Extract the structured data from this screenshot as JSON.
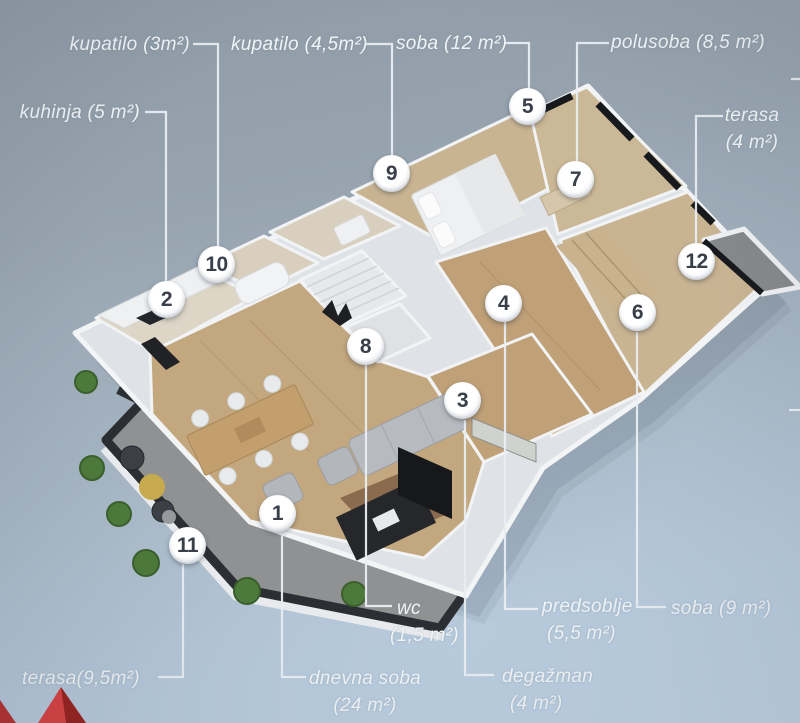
{
  "page": {
    "type": "3d-floor-plan-render"
  },
  "colors": {
    "background_top": "#8e9aa5",
    "background_bottom": "#c0d3e5",
    "label_text": "#f0f4f7",
    "marker_text": "#39404a",
    "connector_line": "#e9eef3",
    "logo_red": "#d84040",
    "logo_red_dark": "#97201c",
    "terrace_wall": "#2b2f34",
    "wood_floor": "#c3a77e",
    "window_glass": "#17191c"
  },
  "markers": [
    {
      "number": "1"
    },
    {
      "number": "2"
    },
    {
      "number": "3"
    },
    {
      "number": "4"
    },
    {
      "number": "5"
    },
    {
      "number": "6"
    },
    {
      "number": "7"
    },
    {
      "number": "8"
    },
    {
      "number": "9"
    },
    {
      "number": "10"
    },
    {
      "number": "11"
    },
    {
      "number": "12"
    }
  ],
  "labels": {
    "kupatilo3": {
      "line1": "kupatilo (3m²)"
    },
    "kupatilo45": {
      "line1": "kupatilo (4,5m²)"
    },
    "soba12": {
      "line1": "soba (12 m²)"
    },
    "polusoba": {
      "line1": "polusoba (8,5 m²)"
    },
    "kuhinja": {
      "line1": "kuhinja (5 m²)"
    },
    "terasa4": {
      "line1": "terasa",
      "line2": "(4 m²)"
    },
    "terasa95": {
      "line1": "terasa(9,5m²)"
    },
    "dnevna": {
      "line1": "dnevna soba",
      "line2": "(24 m²)"
    },
    "wc": {
      "line1": "wc",
      "line2": "(1,5 m²)"
    },
    "predsoblje": {
      "line1": "predsoblje",
      "line2": "(5,5 m²)"
    },
    "soba9": {
      "line1": "soba (9 m²)"
    },
    "degazman": {
      "line1": "degažman",
      "line2": "(4 m²)"
    }
  }
}
